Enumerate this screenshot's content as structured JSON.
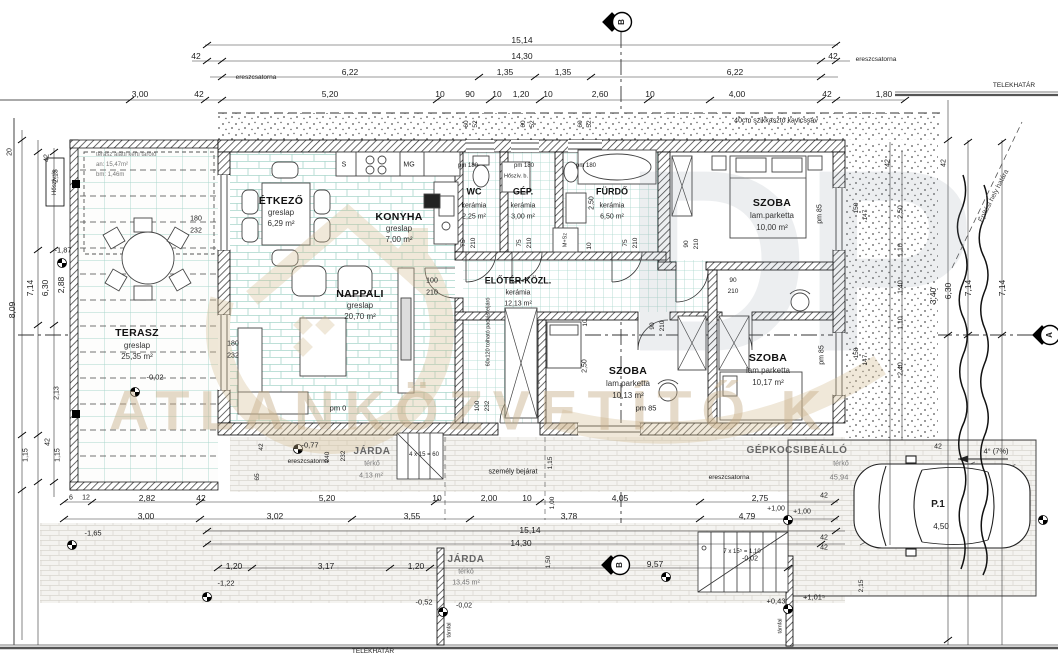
{
  "site": {
    "telekhatar": "TELEKHATÁR",
    "epitesi_hely": "Építési hely határa",
    "kavicssav": "40cm szikkasztó kavicssáv",
    "ereszcsatorna": "ereszcsatorna",
    "tamfal": "támfal",
    "szemely_bejarat": "személy bejárat",
    "marker_a": "A",
    "marker_b": "B"
  },
  "watermark": {
    "letters": "DP",
    "text": "ATLANKÖZVETÍTŐ K"
  },
  "rooms": {
    "terasz": {
      "name": "TERASZ",
      "floor": "greslap",
      "area": "25,35 m²"
    },
    "etkezo": {
      "name": "ÉTKEZŐ",
      "floor": "greslap",
      "area": "6,29 m²"
    },
    "konyha": {
      "name": "KONYHA",
      "floor": "greslap",
      "area": "7,00 m²"
    },
    "nappali": {
      "name": "NAPPALI",
      "floor": "greslap",
      "area": "20,70 m²"
    },
    "wc": {
      "name": "WC",
      "floor": "kerámia",
      "area": "2,25 m²"
    },
    "gep": {
      "name": "GÉP.",
      "floor": "kerámia",
      "area": "3,00 m²"
    },
    "furdo": {
      "name": "FÜRDŐ",
      "floor": "kerámia",
      "area": "6,50 m²"
    },
    "eloter": {
      "name": "ELŐTÉR-KÖZL.",
      "floor": "kerámia",
      "area": "12,13 m²"
    },
    "szoba1": {
      "name": "SZOBA",
      "floor": "lam.parketta",
      "area": "10,00 m²"
    },
    "szoba2": {
      "name": "SZOBA",
      "floor": "lam.parketta",
      "area": "10,13 m²"
    },
    "szoba3": {
      "name": "SZOBA",
      "floor": "lam.parketta",
      "area": "10,17 m²"
    },
    "jarda1": {
      "name": "JÁRDA",
      "floor": "térkő",
      "area": "4,13 m²"
    },
    "jarda2": {
      "name": "JÁRDA",
      "floor": "térkő",
      "area": "13,45 m²"
    }
  },
  "storage": {
    "line1": "terasz alatti kerti tároló",
    "line2": "an: 15,47m²",
    "line3": "bm: 1,46m"
  },
  "equipment": {
    "hosziv_k": "Hőszív. k.",
    "hosziv_b": "Hőszív. b.",
    "msz": "M+Sz",
    "sink": "S",
    "mg": "MG",
    "attic": "60x120 tolható padlásfeljáró"
  },
  "parking": {
    "name": "GÉPKOCSIBEÁLLÓ",
    "surface": "térkő",
    "area": "45,94",
    "space": "P.1",
    "length": "4,50",
    "slope": "4° (7%)"
  },
  "stairs": {
    "entry": "4 x 15 = 60",
    "side": "7 x 15⁵ = 1,10"
  },
  "win": {
    "pm0": "pm 0",
    "pm85": "pm 85",
    "pm180": "pm 180"
  },
  "lv": {
    "m002": "-0,02",
    "m052": "-0,52",
    "m077": "-0,77",
    "m122": "-1,22",
    "m165": "-1,65",
    "m187": "-1,87",
    "p043": "+0,43",
    "p100": "+1,00",
    "p1015": "+1,01⁵"
  },
  "d": {
    "n15_14": "15,14",
    "n14_30": "14,30",
    "n42": "42",
    "n6_22": "6,22",
    "n1_35": "1,35",
    "n3_00": "3,00",
    "n5_20": "5,20",
    "n10": "10",
    "n90": "90",
    "n1_20": "1,20",
    "n2_60": "2,60",
    "n4_00": "4,00",
    "n1_80": "1,80",
    "n60": "60",
    "n52": "52",
    "n20": "20",
    "n2_13": "2,13",
    "n8_09": "8,09",
    "n7_14": "7,14",
    "n6_30": "6,30",
    "n2_88": "2,88",
    "n1_15": "1,15",
    "n6": "6",
    "n12": "12",
    "n2_82": "2,82",
    "n2_00": "2,00",
    "n4_05": "4,05",
    "n2_75": "2,75",
    "n3_02": "3,02",
    "n3_55": "3,55",
    "n3_78": "3,78",
    "n4_79": "4,79",
    "n1_00": "1,00",
    "n3_17": "3,17",
    "n9_57": "9,57",
    "n240": "240",
    "n232": "232",
    "n65": "65",
    "n1_50": "1,50",
    "n2_15": "2,15",
    "n2_50": "2,50",
    "n1_10": "1,10",
    "n1_40": "1,40",
    "n2_40": "2,40",
    "n3_40": "3,40",
    "n150": "150",
    "n147": "147",
    "n158": "158",
    "n180": "180",
    "n100": "100",
    "n210": "210",
    "n75": "75"
  }
}
